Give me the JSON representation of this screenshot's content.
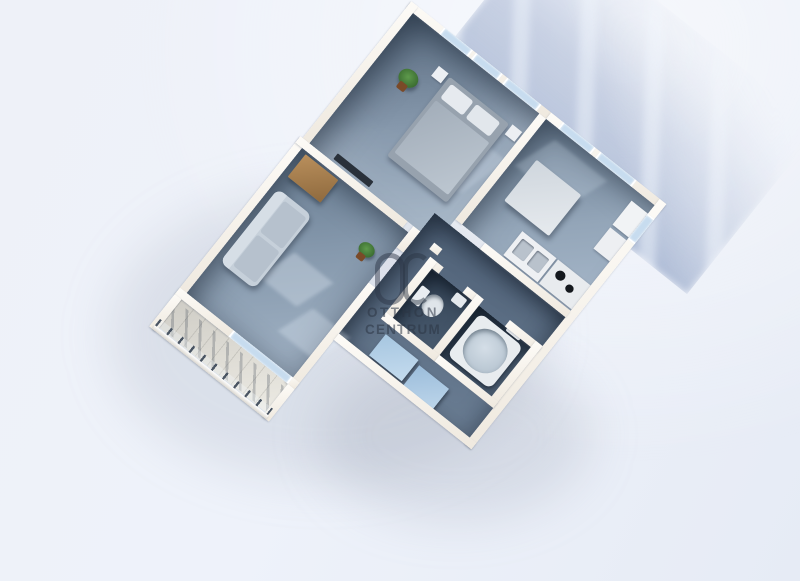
{
  "scene": {
    "type": "3d-floorplan-render",
    "description": "Bird's-eye 3D render of an apartment floor plan rotated diagonally on a pale blue background, with a cast shadow showing window light streaks toward the upper right",
    "rooms": [
      "bedroom",
      "kitchen",
      "living-room",
      "hall",
      "wc",
      "bathroom",
      "balcony"
    ],
    "furniture": {
      "bedroom": [
        "double-bed",
        "pillows",
        "nightstands",
        "wall-tv",
        "potted-plant"
      ],
      "kitchen": [
        "dining-table",
        "sink-counter",
        "stove",
        "fridge",
        "cabinet"
      ],
      "living-room": [
        "sofa",
        "wooden-cabinet",
        "potted-plant"
      ],
      "hall": [
        "blue-cabinet",
        "blue-cabinet"
      ],
      "wc": [
        "toilet",
        "small-sink"
      ],
      "bathroom": [
        "bathtub",
        "wall-sink"
      ],
      "balcony": [
        "railing-posts",
        "glass-parapet"
      ]
    }
  },
  "watermark": {
    "logo_text": "OC",
    "line1": "OTTHON",
    "line2": "CENTRUM"
  },
  "colors": {
    "background": "#ecf0f8",
    "wall": "#f8f4ee",
    "floor_light": "#9fb1c3",
    "floor_mid": "#8799ad",
    "floor_dark": "#4e6076",
    "room_dark": "#3b4c5f",
    "window_glass": "#c7dcef",
    "cast_shadow": "#8c9ec5",
    "blue_cabinet": "#b9d4ea",
    "wood": "#b98f5c",
    "plant_green": "#3f7d33",
    "watermark_text": "#2b3544"
  }
}
